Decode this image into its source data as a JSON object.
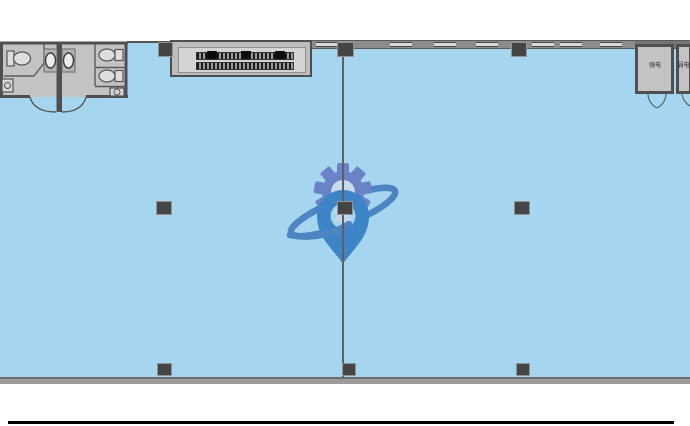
{
  "plan": {
    "rooms": {
      "electrical_room_left": {
        "label": "强电"
      },
      "electrical_room_right": {
        "label": "弱电"
      }
    },
    "watermark_icon": "gear-location-pin-orbit-logo",
    "colors": {
      "floor": "#a6d5f0",
      "wall_dark": "#4f4f4f",
      "wall_mid": "#8c8c8c",
      "window": "#d9d9d9",
      "room_fill": "#c3c3c3",
      "column": "#454545",
      "logo_gear": "#6a82c6",
      "logo_pin": "#3d85c6",
      "logo_ring": "#4d84c2",
      "bottom_rule": "#000000"
    }
  }
}
